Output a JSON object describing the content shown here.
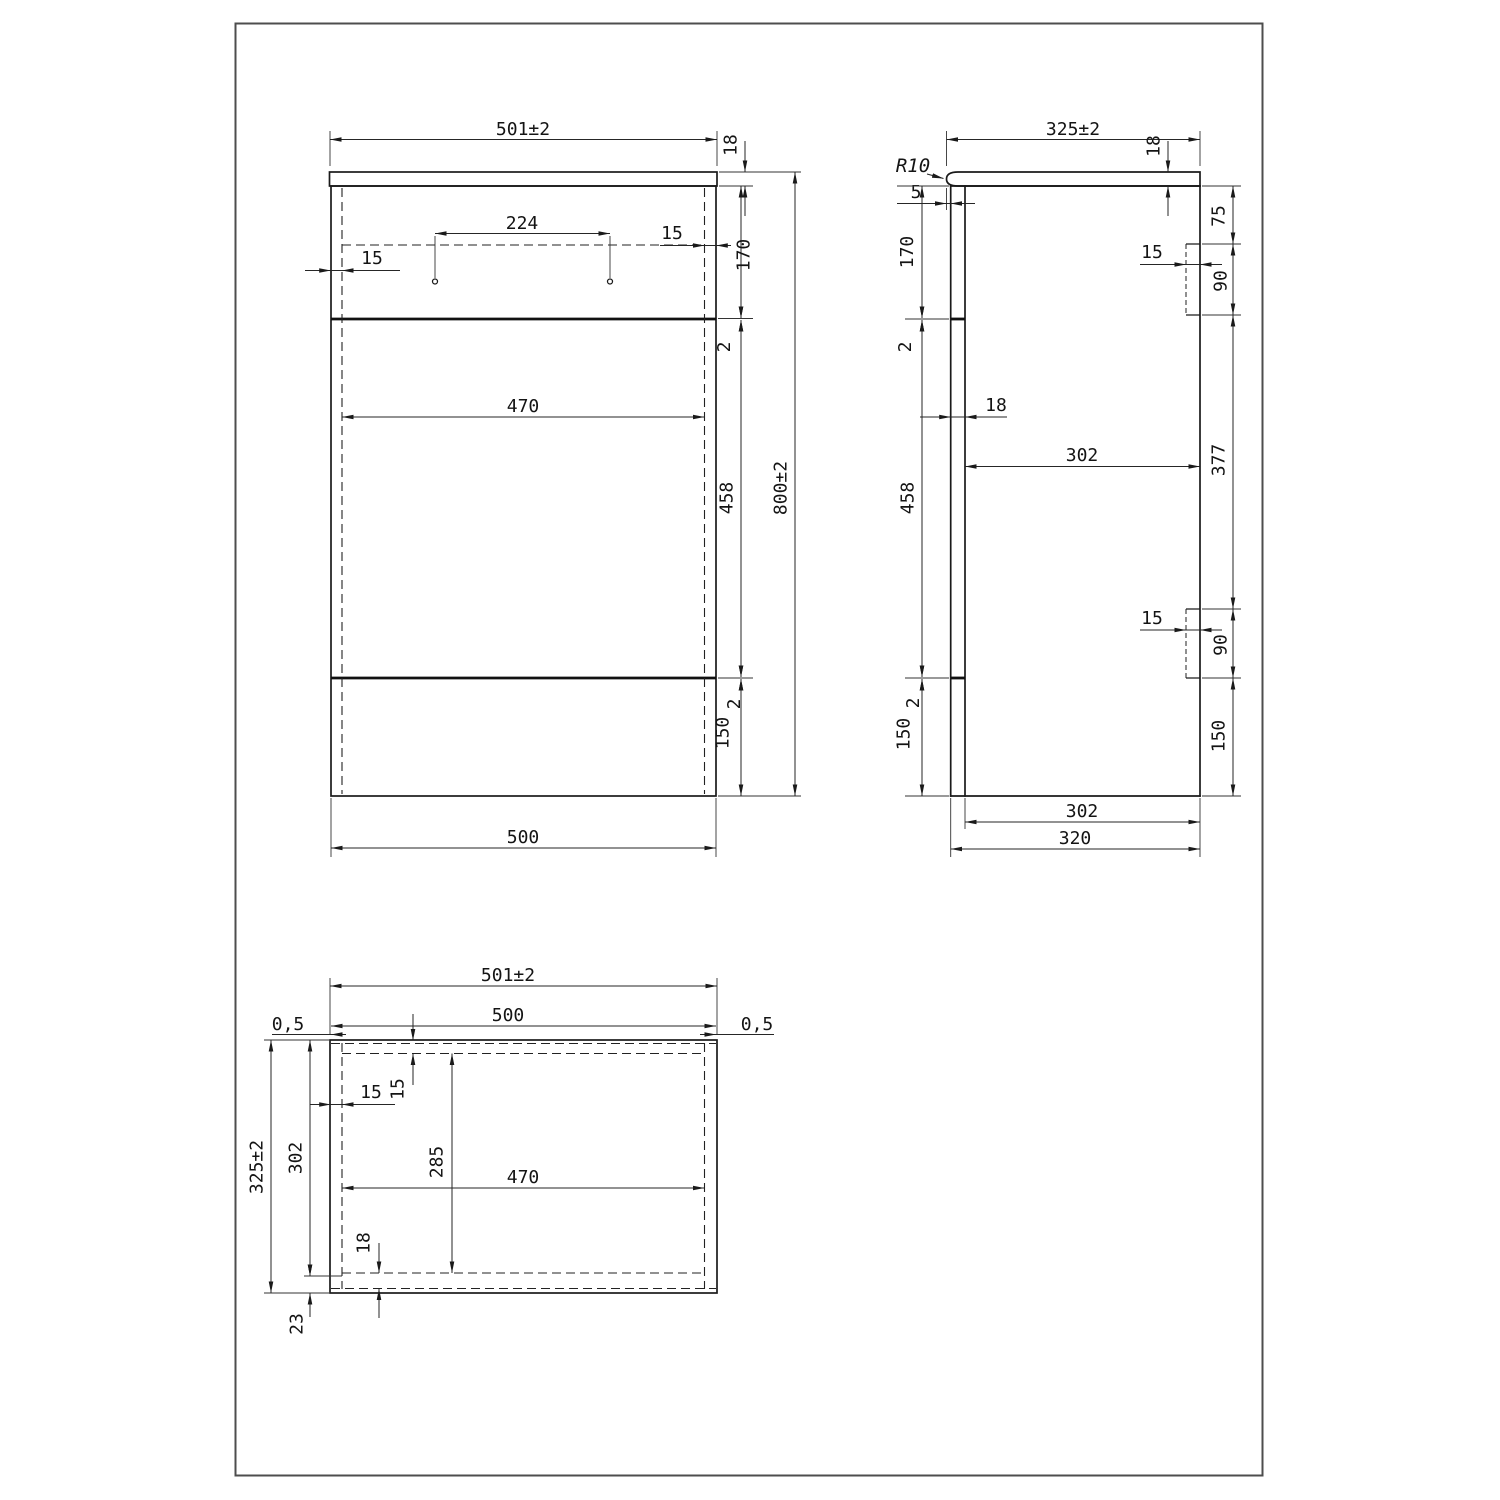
{
  "front": {
    "overall_width": "501±2",
    "top_thickness": "18",
    "handle_spacing": "224",
    "handle_side_offset": "15",
    "side_panel": "15",
    "drawer_height": "170",
    "gap_top": "2",
    "inner_width": "470",
    "door_height": "458",
    "gap_bottom": "2",
    "plinth": "150",
    "overall_height": "800±2",
    "body_width": "500"
  },
  "side": {
    "overall_depth": "325±2",
    "top_thickness": "18",
    "radius": "R10",
    "overhang": "5",
    "drawer_height": "170",
    "gap_top": "2",
    "front_thickness": "18",
    "inner_depth": "302",
    "door_height": "458",
    "gap_bottom": "2",
    "plinth_front": "150",
    "bracket_offset": "75",
    "bracket_width_top": "15",
    "bracket_height_top": "90",
    "bracket_span": "377",
    "bracket_width_bottom": "15",
    "bracket_height_bottom": "90",
    "plinth_back": "150",
    "inner_depth_bottom": "302",
    "body_depth": "320"
  },
  "plan": {
    "overall_width": "501±2",
    "body_width": "500",
    "overhang_left": "0,5",
    "overhang_right": "0,5",
    "front_rail": "15",
    "side_panel": "15",
    "inner_depth_front": "302",
    "overall_depth": "325±2",
    "inner_depth": "285",
    "inner_width": "470",
    "back_thickness": "18",
    "back_offset": "23"
  }
}
